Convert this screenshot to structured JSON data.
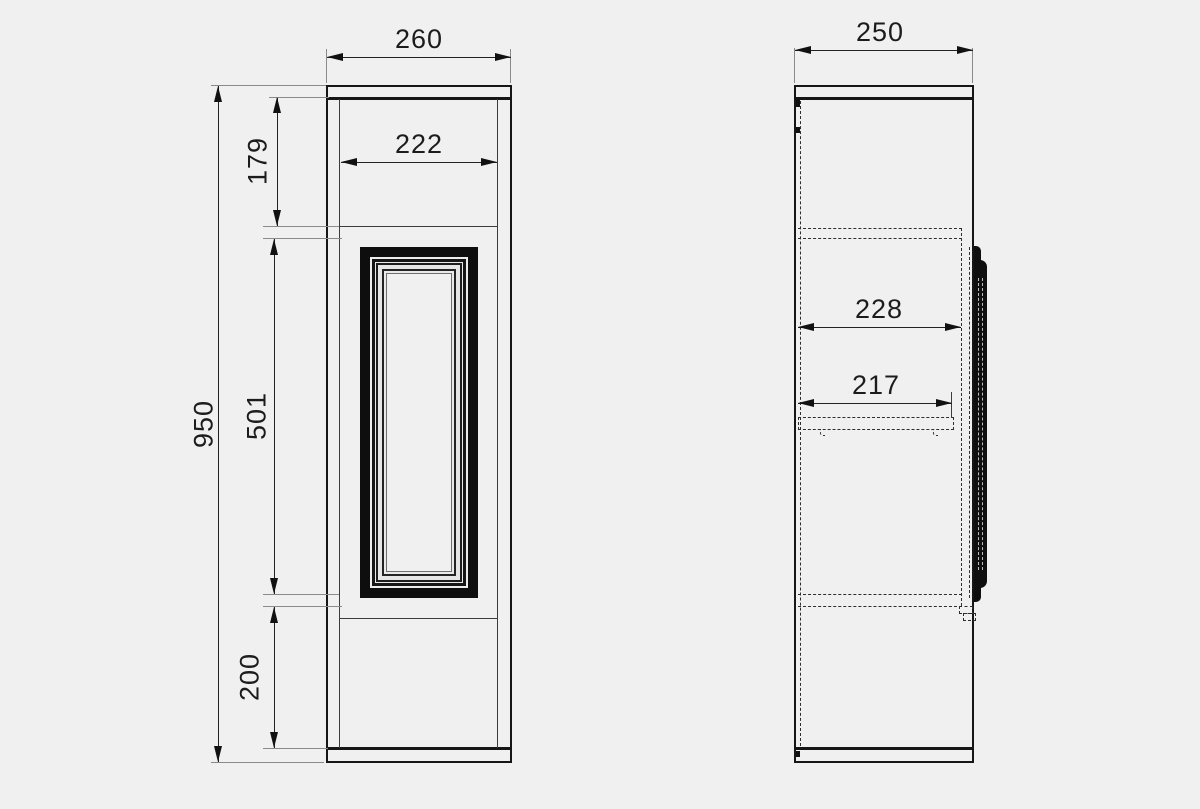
{
  "colors": {
    "background": "#f0f0f0",
    "line": "#1a1a1a"
  },
  "front_view": {
    "dimensions": {
      "overall_width": "260",
      "opening_width": "222",
      "top_section_height": "179",
      "overall_height": "950",
      "door_height": "501",
      "bottom_section_height": "200"
    }
  },
  "side_view": {
    "dimensions": {
      "overall_depth": "250",
      "door_opening_depth": "228",
      "shelf_depth": "217"
    }
  }
}
